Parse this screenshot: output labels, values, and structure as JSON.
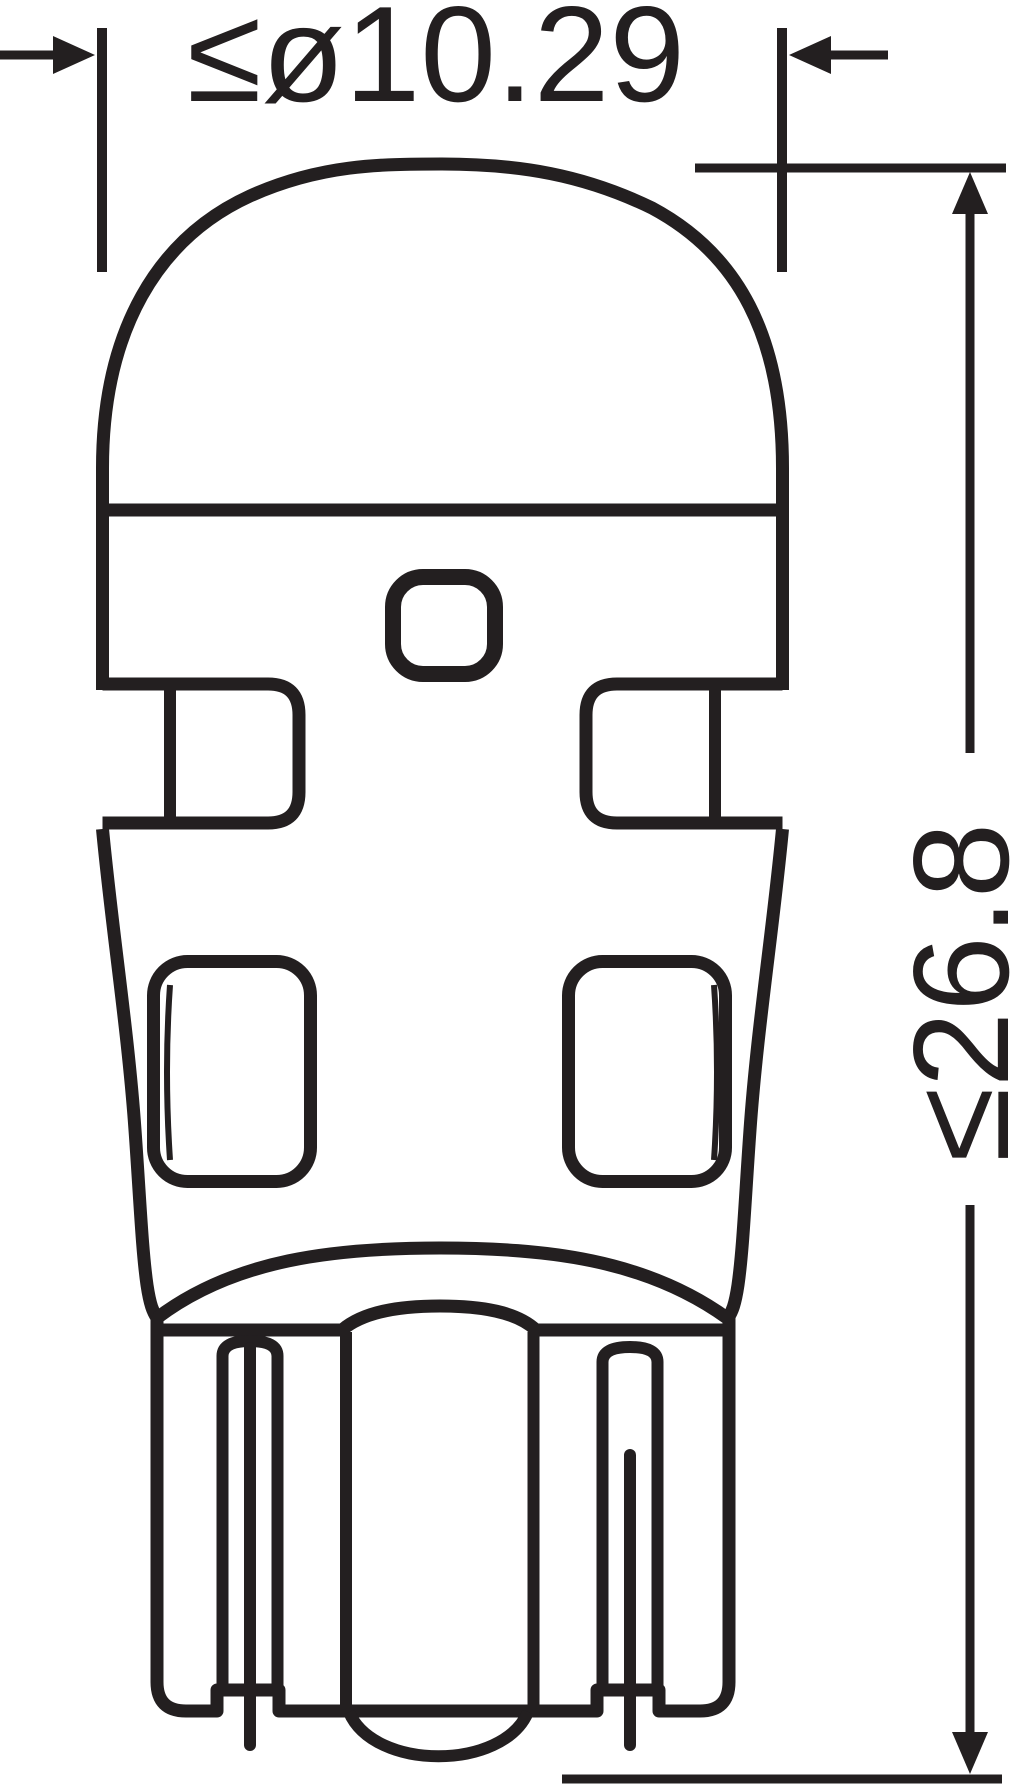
{
  "drawing": {
    "kind": "technical-dimension-drawing",
    "dimensions": {
      "diameter_label": "≤ø10.29",
      "height_label": "≤26.8"
    },
    "colors": {
      "ink": "#231f20",
      "background": "#ffffff"
    }
  }
}
